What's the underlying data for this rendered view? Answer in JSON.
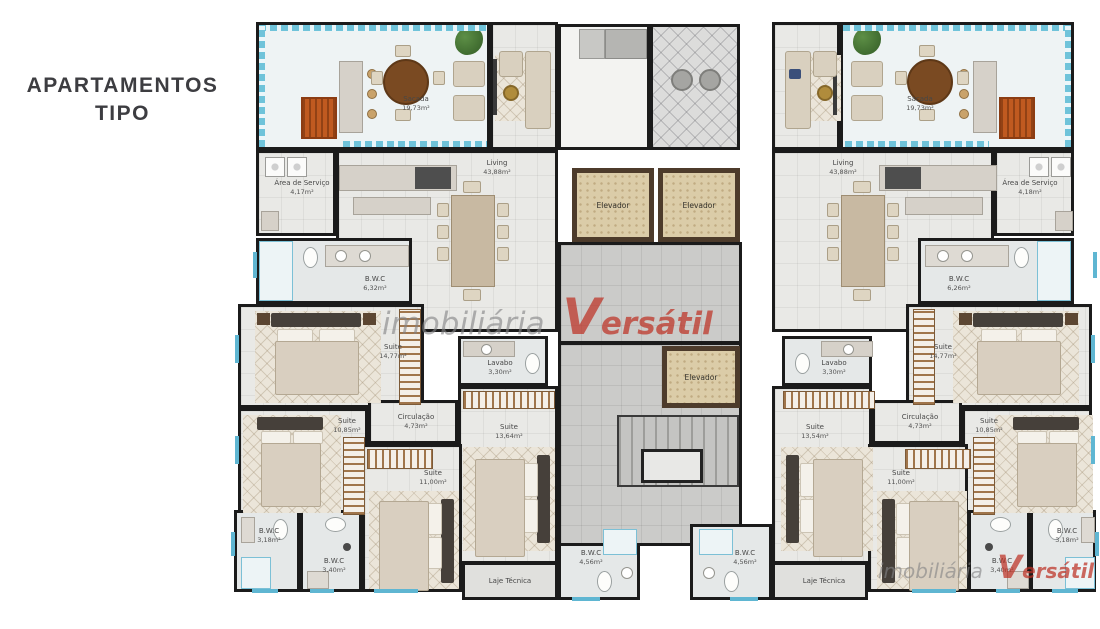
{
  "title": {
    "line1": "APARTAMENTOS",
    "line2": "TIPO"
  },
  "watermark": {
    "word1": "imobiliária",
    "word2": "Versátil"
  },
  "colors": {
    "watermark_red": "#bc3024",
    "watermark_gray": "#828284",
    "window_blue": "#5fb6d2",
    "wall_black": "#1b1b1b",
    "elevator_shaft_brown": "#4d3b2b"
  },
  "core": {
    "elevators": [
      "Elevador",
      "Elevador",
      "Elevador"
    ]
  },
  "left": {
    "sacada": {
      "name": "Sacada",
      "area": "19,73m²"
    },
    "servico": {
      "name": "Área de Serviço",
      "area": "4,17m²"
    },
    "living": {
      "name": "Living",
      "area": "43,88m²"
    },
    "bwc_suite": {
      "name": "B.W.C",
      "area": "6,32m²"
    },
    "suite_master": {
      "name": "Suite",
      "area": "14,77m²"
    },
    "suite2": {
      "name": "Suite",
      "area": "10,85m²"
    },
    "circulacao": {
      "name": "Circulação",
      "area": "4,73m²"
    },
    "lavabo": {
      "name": "Lavabo",
      "area": "3,30m²"
    },
    "suite3": {
      "name": "Suite",
      "area": "13,64m²"
    },
    "suite4": {
      "name": "Suite",
      "area": "11,00m²"
    },
    "bwc2": {
      "name": "B.W.C",
      "area": "3,18m²"
    },
    "bwc3": {
      "name": "B.W.C",
      "area": "3,40m²"
    },
    "bwc_servico": {
      "name": "B.W.C",
      "area": "4,56m²"
    },
    "laje": {
      "name": "Laje Técnica"
    }
  },
  "right": {
    "sacada": {
      "name": "Sacada",
      "area": "19,73m²"
    },
    "servico": {
      "name": "Área de Serviço",
      "area": "4,18m²"
    },
    "living": {
      "name": "Living",
      "area": "43,88m²"
    },
    "bwc_suite": {
      "name": "B.W.C",
      "area": "6,26m²"
    },
    "suite_master": {
      "name": "Suite",
      "area": "14,77m²"
    },
    "suite2": {
      "name": "Suite",
      "area": "10,85m²"
    },
    "circulacao": {
      "name": "Circulação",
      "area": "4,73m²"
    },
    "lavabo": {
      "name": "Lavabo",
      "area": "3,30m²"
    },
    "suite3": {
      "name": "Suite",
      "area": "13,54m²"
    },
    "suite4": {
      "name": "Suite",
      "area": "11,00m²"
    },
    "bwc2": {
      "name": "B.W.C",
      "area": "3,18m²"
    },
    "bwc3": {
      "name": "B.W.C",
      "area": "3,40m²"
    },
    "bwc_servico": {
      "name": "B.W.C",
      "area": "4,56m²"
    },
    "laje": {
      "name": "Laje Técnica"
    }
  }
}
